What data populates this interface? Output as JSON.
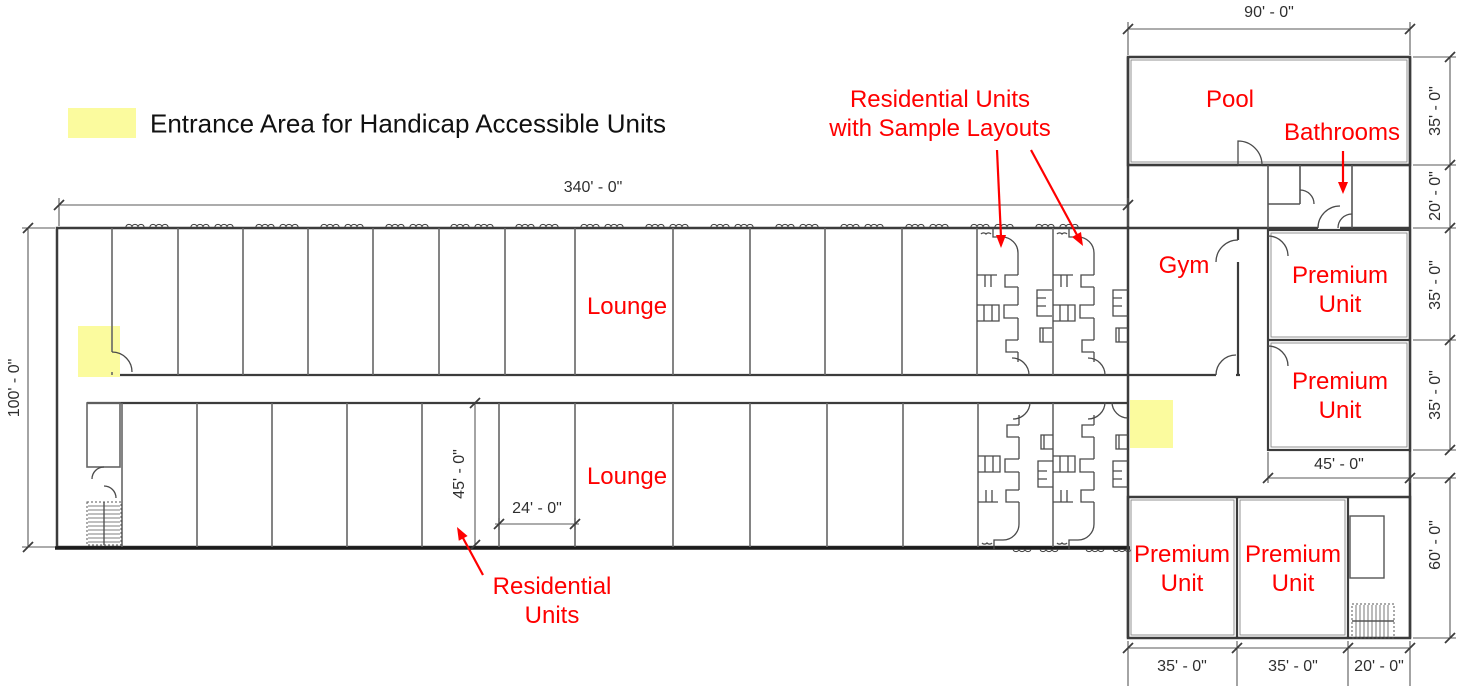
{
  "colors": {
    "annotation_red": "#FF0000",
    "highlight_yellow": "#FBFB9E",
    "wall_dark": "#3C3C3C",
    "wall_light": "#666666",
    "dim_text": "#2F2F2F"
  },
  "legend": {
    "label": "Entrance Area for Handicap Accessible Units"
  },
  "rooms": {
    "pool": "Pool",
    "gym": "Gym",
    "bathrooms": "Bathrooms",
    "lounge": "Lounge",
    "premium_line1": "Premium",
    "premium_line2": "Unit"
  },
  "annotations": {
    "sample_units_line1": "Residential Units",
    "sample_units_line2": "with Sample Layouts",
    "residential_line1": "Residential",
    "residential_line2": "Units"
  },
  "dims": {
    "main_width": "340' - 0\"",
    "main_height": "100' - 0\"",
    "wing_width": "90' - 0\"",
    "pool_depth": "35' - 0\"",
    "bath_depth": "20' - 0\"",
    "premium_right_1": "35' - 0\"",
    "premium_right_2": "35' - 0\"",
    "premium_col_width": "45' - 0\"",
    "wing_bottom_height": "60' - 0\"",
    "unit_depth": "45' - 0\"",
    "unit_width": "24' - 0\"",
    "bottom_premium_1": "35' - 0\"",
    "bottom_premium_2": "35' - 0\"",
    "bottom_stair_width": "20' - 0\""
  }
}
